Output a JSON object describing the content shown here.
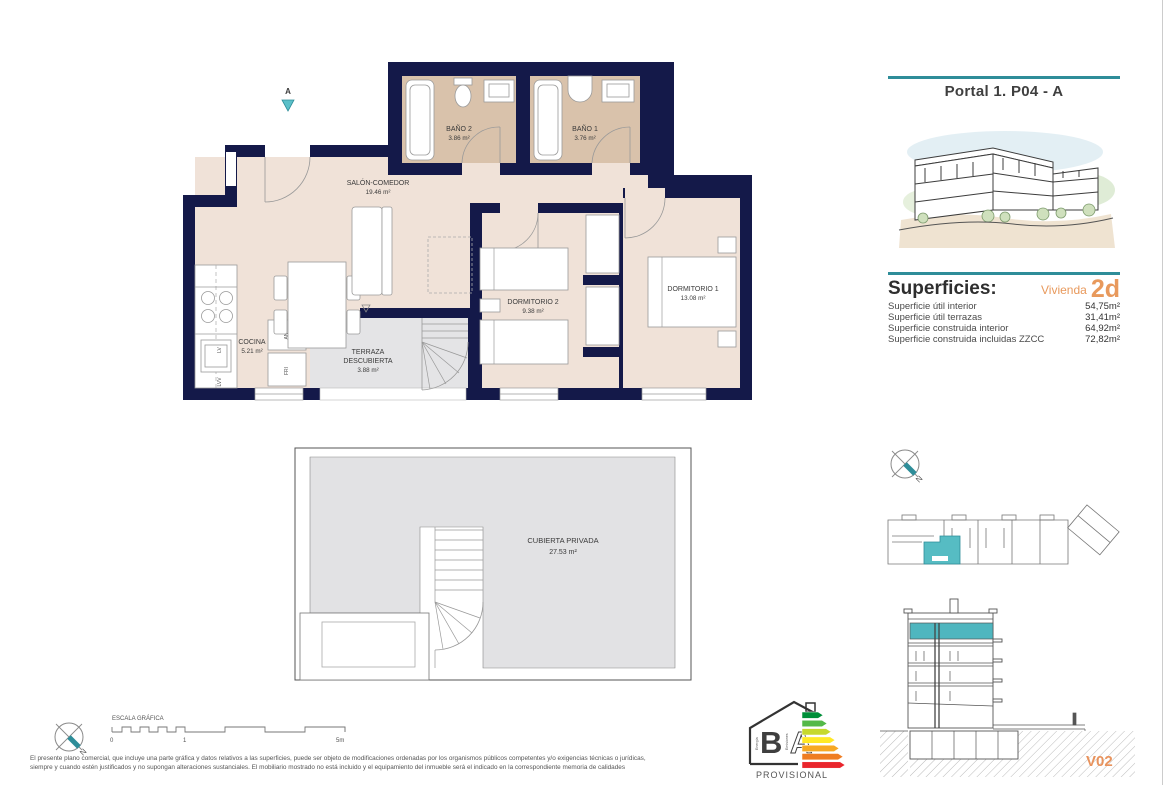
{
  "header": {
    "title": "Portal 1. P04 - A"
  },
  "superficies": {
    "title": "Superficies:",
    "vivienda_label": "Vivienda",
    "vivienda_code": "2d",
    "rows": [
      {
        "label": "Superficie útil interior",
        "value": "54,75m²"
      },
      {
        "label": "Superficie útil terrazas",
        "value": "31,41m²"
      },
      {
        "label": "Superficie construida interior",
        "value": "64,92m²"
      },
      {
        "label": "Superficie construida incluidas ZZCC",
        "value": "72,82m²"
      }
    ]
  },
  "floor_plan": {
    "entrance_marker": "A",
    "salon": {
      "name": "SALÓN-COMEDOR",
      "area": "19.46 m²"
    },
    "banio2": {
      "name": "BAÑO 2",
      "area": "3.86 m²"
    },
    "banio1": {
      "name": "BAÑO 1",
      "area": "3.76 m²"
    },
    "cocina": {
      "name": "COCINA",
      "area": "5.21 m²"
    },
    "terraza": {
      "name_line1": "TERRAZA",
      "name_line2": "DESCUBIERTA",
      "area": "3.88 m²"
    },
    "dormitorio2": {
      "name": "DORMITORIO 2",
      "area": "9.38 m²"
    },
    "dormitorio1": {
      "name": "DORMITORIO 1",
      "area": "13.08 m²"
    },
    "appliances": {
      "lv": "LV",
      "lvv": "LVV",
      "an": "AN",
      "fri": "FRI"
    }
  },
  "roof_plan": {
    "name": "CUBIERTA PRIVADA",
    "area": "27.53 m²"
  },
  "scale_bar": {
    "title": "ESCALA GRÁFICA",
    "tick0": "0",
    "tick1": "1",
    "tick2": "5m"
  },
  "compass": {
    "north": "N"
  },
  "footer": {
    "disclaimer_line1": "El presente plano comercial, que incluye una parte gráfica y datos relativos a las superficies, puede ser objeto de modificaciones ordenadas por los organismos públicos competentes y/o exigencias técnicas o jurídicas,",
    "disclaimer_line2": "siempre y cuando estén justificados y no supongan alteraciones sustanciales. El mobiliario mostrado no está incluido y el equipamiento del inmueble será el indicado en la correspondiente memoria de calidades"
  },
  "logo": {
    "letter_b": "B",
    "letter_a": "A",
    "text_energia": "Energía",
    "text_emisiones": "Emisiones",
    "provisional": "PROVISIONAL"
  },
  "version": "V02",
  "colors": {
    "wall_navy": "#141949",
    "floor_beige": "#f0e2d8",
    "bath_floor_tan": "#d9c2ab",
    "terrace_gray": "#e4e4e6",
    "accent_teal": "#2e8d99",
    "highlight_teal": "#58bcc3",
    "accent_orange": "#e8995c",
    "energy_arrows": [
      "#008f39",
      "#54b948",
      "#c6d92d",
      "#ffe926",
      "#f7a823",
      "#ef7d22",
      "#e9252c"
    ]
  }
}
